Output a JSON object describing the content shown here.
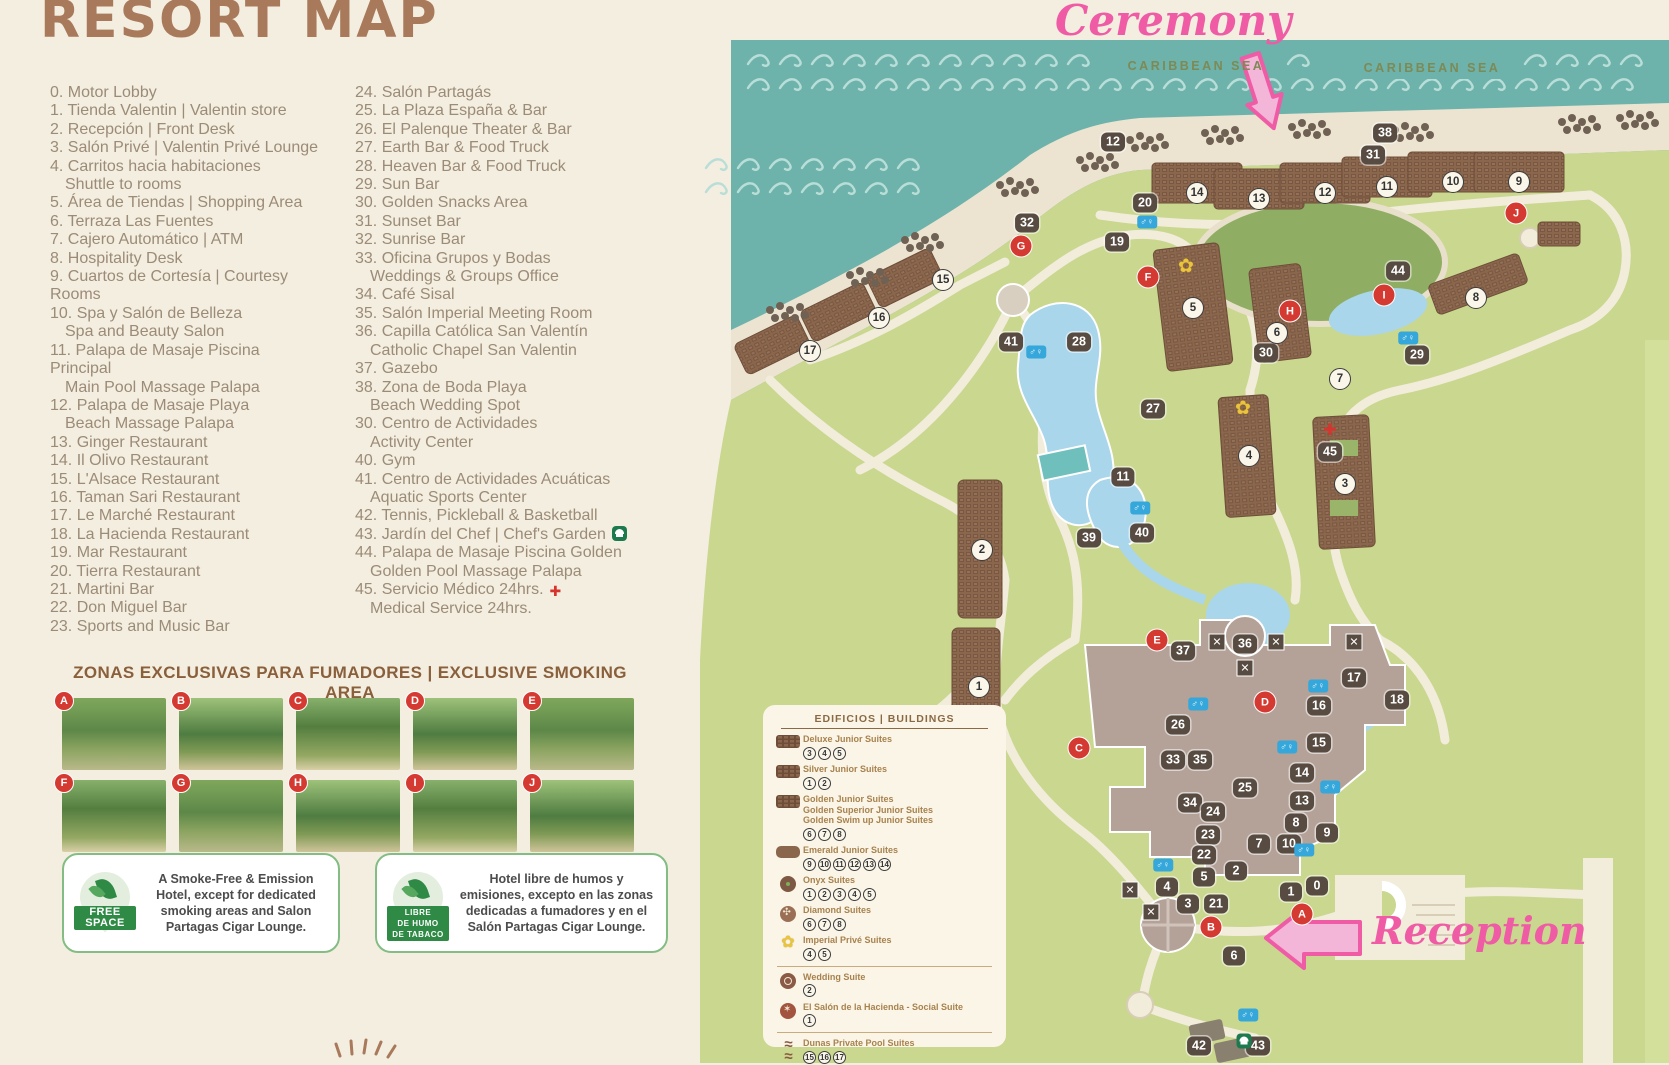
{
  "title": "RESORT MAP",
  "directory": {
    "col1": [
      {
        "t": "0. Motor Lobby"
      },
      {
        "t": "1. Tienda Valentin | Valentin store"
      },
      {
        "t": "2. Recepción | Front Desk"
      },
      {
        "t": "3. Salón Privé | Valentin Privé Lounge"
      },
      {
        "t": "4. Carritos hacia habitaciones\n Shuttle to rooms"
      },
      {
        "t": "5. Área de Tiendas | Shopping Area"
      },
      {
        "t": "6. Terraza Las Fuentes"
      },
      {
        "t": "7. Cajero Automático | ATM"
      },
      {
        "t": "8. Hospitality Desk"
      },
      {
        "t": "9. Cuartos de Cortesía | Courtesy\nRooms"
      },
      {
        "t": "10. Spa y Salón de Belleza\n Spa and Beauty Salon"
      },
      {
        "t": "11. Palapa de Masaje Piscina\nPrincipal\n Main Pool Massage Palapa"
      },
      {
        "t": "12. Palapa de Masaje Playa\n Beach Massage Palapa"
      },
      {
        "t": "13. Ginger Restaurant"
      },
      {
        "t": "14. Il Olivo Restaurant"
      },
      {
        "t": "15. L'Alsace Restaurant"
      },
      {
        "t": "16. Taman Sari Restaurant"
      },
      {
        "t": "17. Le Marché Restaurant"
      },
      {
        "t": "18. La Hacienda Restaurant"
      },
      {
        "t": "19. Mar Restaurant"
      },
      {
        "t": "20. Tierra Restaurant"
      },
      {
        "t": "21. Martini Bar"
      },
      {
        "t": "22. Don Miguel Bar"
      },
      {
        "t": "23. Sports and Music Bar"
      }
    ],
    "col2": [
      {
        "t": "24. Salón Partagás"
      },
      {
        "t": "25. La Plaza España & Bar"
      },
      {
        "t": "26. El Palenque Theater & Bar"
      },
      {
        "t": "27. Earth Bar & Food Truck"
      },
      {
        "t": "28. Heaven Bar & Food Truck"
      },
      {
        "t": "29. Sun Bar"
      },
      {
        "t": "30. Golden Snacks Area"
      },
      {
        "t": "31. Sunset Bar"
      },
      {
        "t": "32. Sunrise Bar"
      },
      {
        "t": "33. Oficina Grupos y Bodas\n Weddings & Groups Office"
      },
      {
        "t": "34. Café Sisal"
      },
      {
        "t": "35. Salón Imperial Meeting Room"
      },
      {
        "t": "36. Capilla Católica San Valentín\n Catholic Chapel San Valentin"
      },
      {
        "t": "37. Gazebo"
      },
      {
        "t": "38. Zona de Boda Playa\n Beach Wedding Spot"
      },
      {
        "t": "30. Centro de Actividades\n Activity Center"
      },
      {
        "t": "40. Gym"
      },
      {
        "t": "41. Centro de Actividades Acuáticas\n Aquatic Sports Center"
      },
      {
        "t": "42. Tennis, Pickleball & Basketball"
      },
      {
        "t": "43. Jardín del Chef | Chef's Garden",
        "icon": "chef"
      },
      {
        "t": "44. Palapa de Masaje Piscina Golden\n Golden Pool Massage Palapa"
      },
      {
        "t": "45. Servicio Médico 24hrs.\n Medical Service 24hrs.",
        "icon": "medical"
      }
    ]
  },
  "smoking": {
    "header": "ZONAS EXCLUSIVAS PARA FUMADORES | EXCLUSIVE SMOKING AREA",
    "photo_letters": [
      "A",
      "B",
      "C",
      "D",
      "E",
      "F",
      "G",
      "H",
      "I",
      "J"
    ]
  },
  "info_boxes": [
    {
      "badge": [
        "FREE",
        "SPACE"
      ],
      "text": "A Smoke-Free & Emission Hotel, except for dedicated smoking areas and Salon Partagas Cigar Lounge."
    },
    {
      "badge": [
        "LIBRE",
        "DE HUMO",
        "DE TABACO"
      ],
      "text": "Hotel libre de humos y emisiones, excepto en las zonas dedicadas a fumadores y en el Salón Partagas Cigar Lounge."
    }
  ],
  "map": {
    "sea_labels": [
      "CARIBBEAN SEA",
      "CARIBBEAN SEA"
    ],
    "annotations": {
      "ceremony": "Ceremony",
      "reception": "Reception"
    },
    "legend": {
      "title": "EDIFICIOS | BUILDINGS",
      "rows": [
        {
          "icon": "deluxe",
          "lines": [
            "Deluxe Junior Suites"
          ],
          "units": [
            "3",
            "4",
            "5"
          ]
        },
        {
          "icon": "silver",
          "lines": [
            "Silver Junior Suites"
          ],
          "units": [
            "1",
            "2"
          ]
        },
        {
          "icon": "golden",
          "lines": [
            "Golden Junior Suites",
            "Golden Superior Junior Suites",
            "Golden Swim up Junior Suites"
          ],
          "units": [
            "6",
            "7",
            "8"
          ]
        },
        {
          "icon": "emerald",
          "lines": [
            "Emerald Junior Suites"
          ],
          "units": [
            "9",
            "10",
            "11",
            "12",
            "13",
            "14"
          ]
        },
        {
          "icon": "onyx",
          "lines": [
            "Onyx Suites"
          ],
          "units": [
            "1",
            "2",
            "3",
            "4",
            "5"
          ]
        },
        {
          "icon": "diamond",
          "lines": [
            "Diamond Suites"
          ],
          "units": [
            "6",
            "7",
            "8"
          ]
        },
        {
          "icon": "imperial",
          "lines": [
            "Imperial Privé Suites"
          ],
          "units": [
            "4",
            "5"
          ],
          "divider_after": true
        },
        {
          "icon": "wedding",
          "lines": [
            "Wedding Suite"
          ],
          "units": [
            "2"
          ]
        },
        {
          "icon": "hacienda",
          "lines": [
            "El Salón de la Hacienda - Social Suite"
          ],
          "units": [
            "1"
          ],
          "divider_after": true
        },
        {
          "icon": "dunas",
          "lines": [
            "Dunas Private Pool Suites"
          ],
          "units": [
            "15",
            "16",
            "17"
          ]
        }
      ]
    },
    "badges": [
      {
        "n": "12",
        "x": 1113,
        "y": 142
      },
      {
        "n": "38",
        "x": 1385,
        "y": 133
      },
      {
        "n": "31",
        "x": 1373,
        "y": 155
      },
      {
        "n": "20",
        "x": 1145,
        "y": 203
      },
      {
        "n": "19",
        "x": 1117,
        "y": 242
      },
      {
        "n": "32",
        "x": 1027,
        "y": 223
      },
      {
        "n": "41",
        "x": 1011,
        "y": 342
      },
      {
        "n": "28",
        "x": 1079,
        "y": 342
      },
      {
        "n": "27",
        "x": 1153,
        "y": 409
      },
      {
        "n": "44",
        "x": 1398,
        "y": 271
      },
      {
        "n": "30",
        "x": 1266,
        "y": 353
      },
      {
        "n": "29",
        "x": 1417,
        "y": 355
      },
      {
        "n": "45",
        "x": 1330,
        "y": 452
      },
      {
        "n": "11",
        "x": 1123,
        "y": 477
      },
      {
        "n": "40",
        "x": 1142,
        "y": 533
      },
      {
        "n": "39",
        "x": 1089,
        "y": 538
      },
      {
        "n": "37",
        "x": 1183,
        "y": 651
      },
      {
        "n": "36",
        "x": 1245,
        "y": 644
      },
      {
        "n": "26",
        "x": 1178,
        "y": 725
      },
      {
        "n": "33",
        "x": 1173,
        "y": 760
      },
      {
        "n": "35",
        "x": 1200,
        "y": 760
      },
      {
        "n": "25",
        "x": 1245,
        "y": 788
      },
      {
        "n": "34",
        "x": 1190,
        "y": 803
      },
      {
        "n": "24",
        "x": 1213,
        "y": 812
      },
      {
        "n": "23",
        "x": 1208,
        "y": 835
      },
      {
        "n": "22",
        "x": 1204,
        "y": 855
      },
      {
        "n": "17",
        "x": 1354,
        "y": 678
      },
      {
        "n": "16",
        "x": 1319,
        "y": 706
      },
      {
        "n": "18",
        "x": 1397,
        "y": 700
      },
      {
        "n": "15",
        "x": 1319,
        "y": 743
      },
      {
        "n": "14",
        "x": 1302,
        "y": 773
      },
      {
        "n": "13",
        "x": 1302,
        "y": 801
      },
      {
        "n": "8",
        "x": 1296,
        "y": 823
      },
      {
        "n": "9",
        "x": 1327,
        "y": 833
      },
      {
        "n": "7",
        "x": 1259,
        "y": 844
      },
      {
        "n": "10",
        "x": 1289,
        "y": 844
      },
      {
        "n": "2",
        "x": 1236,
        "y": 871
      },
      {
        "n": "5",
        "x": 1204,
        "y": 877
      },
      {
        "n": "4",
        "x": 1167,
        "y": 887
      },
      {
        "n": "3",
        "x": 1188,
        "y": 904
      },
      {
        "n": "21",
        "x": 1216,
        "y": 904
      },
      {
        "n": "1",
        "x": 1291,
        "y": 892
      },
      {
        "n": "0",
        "x": 1317,
        "y": 886
      },
      {
        "n": "6",
        "x": 1234,
        "y": 956
      },
      {
        "n": "42",
        "x": 1199,
        "y": 1046
      },
      {
        "n": "43",
        "x": 1258,
        "y": 1046
      }
    ],
    "building_circles": [
      {
        "n": "9",
        "x": 1519,
        "y": 182
      },
      {
        "n": "10",
        "x": 1453,
        "y": 182
      },
      {
        "n": "11",
        "x": 1387,
        "y": 187
      },
      {
        "n": "12",
        "x": 1325,
        "y": 193
      },
      {
        "n": "13",
        "x": 1259,
        "y": 199
      },
      {
        "n": "14",
        "x": 1197,
        "y": 193
      },
      {
        "n": "15",
        "x": 943,
        "y": 280
      },
      {
        "n": "16",
        "x": 879,
        "y": 318
      },
      {
        "n": "17",
        "x": 810,
        "y": 351
      },
      {
        "n": "5",
        "x": 1193,
        "y": 308
      },
      {
        "n": "6",
        "x": 1277,
        "y": 333
      },
      {
        "n": "4",
        "x": 1249,
        "y": 456
      },
      {
        "n": "3",
        "x": 1345,
        "y": 484
      },
      {
        "n": "7",
        "x": 1340,
        "y": 379
      },
      {
        "n": "8",
        "x": 1476,
        "y": 298
      },
      {
        "n": "2",
        "x": 982,
        "y": 550
      },
      {
        "n": "1",
        "x": 979,
        "y": 687
      }
    ],
    "smoking_letters": [
      {
        "n": "A",
        "x": 1302,
        "y": 914
      },
      {
        "n": "B",
        "x": 1211,
        "y": 927
      },
      {
        "n": "C",
        "x": 1079,
        "y": 748
      },
      {
        "n": "D",
        "x": 1265,
        "y": 702
      },
      {
        "n": "E",
        "x": 1157,
        "y": 640
      },
      {
        "n": "F",
        "x": 1148,
        "y": 277
      },
      {
        "n": "G",
        "x": 1021,
        "y": 246
      },
      {
        "n": "H",
        "x": 1290,
        "y": 311
      },
      {
        "n": "I",
        "x": 1384,
        "y": 295
      },
      {
        "n": "J",
        "x": 1516,
        "y": 213
      }
    ],
    "restrooms": [
      {
        "x": 1147,
        "y": 222
      },
      {
        "x": 1036,
        "y": 352
      },
      {
        "x": 1408,
        "y": 338
      },
      {
        "x": 1140,
        "y": 508
      },
      {
        "x": 1198,
        "y": 704
      },
      {
        "x": 1318,
        "y": 686
      },
      {
        "x": 1287,
        "y": 747
      },
      {
        "x": 1330,
        "y": 787
      },
      {
        "x": 1304,
        "y": 850
      },
      {
        "x": 1163,
        "y": 865
      },
      {
        "x": 1248,
        "y": 1015
      }
    ],
    "medical_marker": {
      "x": 1330,
      "y": 430
    },
    "chef_marker": {
      "x": 1238,
      "y": 1041
    },
    "imperial_flowers": [
      {
        "x": 1186,
        "y": 266
      },
      {
        "x": 1243,
        "y": 408
      }
    ]
  }
}
